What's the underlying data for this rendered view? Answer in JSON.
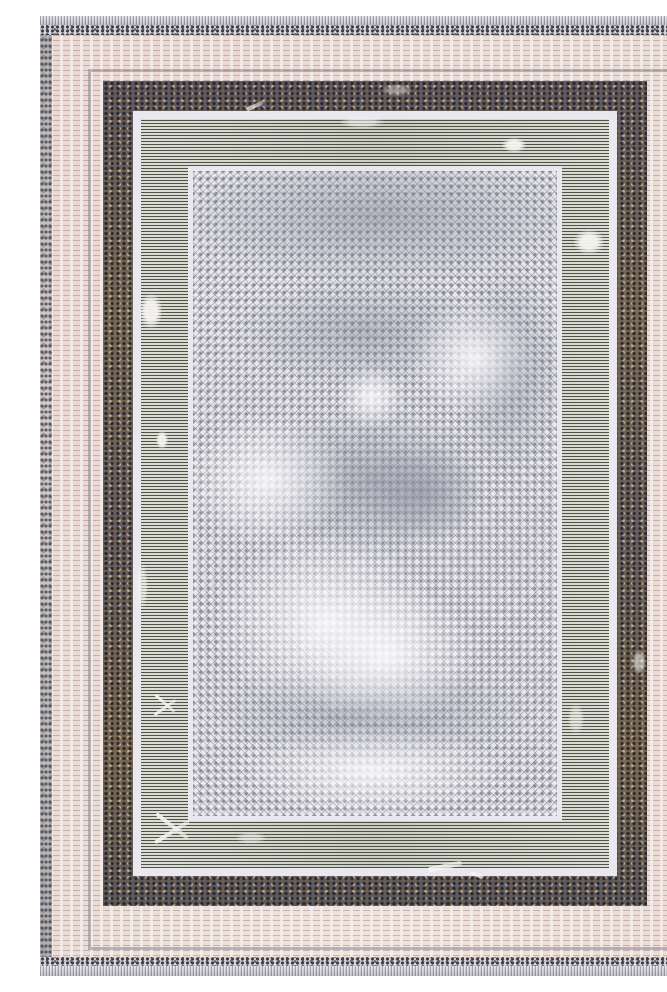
{
  "meta": {
    "type": "product-photo",
    "subject": "vintage-style distressed area rug, flat top-down view",
    "alt": "Blush-beige and grey distressed area rug with nested rectangular borders: speckled guard stripes and fringe at top and bottom, a blush outer border with a thin pencil line, a mottled charcoal-brown border, ivory lines, an olive-grey pinstripe band, and a faded diamond trellis centre field"
  },
  "palette": {
    "fringe": "#cdcdd5",
    "speckleBase": "#d8d6da",
    "speckleDot": "#3c3c44",
    "creamBase": "#ecdcd6",
    "edge": "#cfc9cb",
    "thinLine": "#8f8f98",
    "darkBorder": "#6b6560",
    "darkBorderBrown": "#8d7257",
    "darkBorderTan": "#bba88f",
    "whiteLine": "#e9e8ee",
    "bandDark": "#4f5449",
    "bandLight": "#d8d7d0",
    "fieldBase": "#e7e7eb",
    "fieldLattice": "#8e909c",
    "cloudDark": "#9296a6",
    "cloudLight": "#f8f8fa"
  },
  "layers": [
    {
      "name": "fringe-top",
      "description": "pale grey stitched fringe strip",
      "color": "#cdcdd5"
    },
    {
      "name": "guard-stripe",
      "description": "dense dark speckled stripe",
      "color": "#3c3c44"
    },
    {
      "name": "outer-border",
      "description": "blush cream distressed border with fine dark dashes",
      "color": "#ecdcd6"
    },
    {
      "name": "pencil-line",
      "description": "thin grey rectangle line",
      "color": "#8f8f98"
    },
    {
      "name": "mottled-border",
      "description": "charcoal grey and rust-brown mottled border",
      "color": "#6b6560"
    },
    {
      "name": "ivory-line-outer",
      "description": "ivory separator line",
      "color": "#e9e8ee"
    },
    {
      "name": "pinstripe-band",
      "description": "olive-grey fine horizontal pinstripe band with white abrasion",
      "color": "#4f5449"
    },
    {
      "name": "ivory-line-inner",
      "description": "ivory separator line",
      "color": "#e9e8ee"
    },
    {
      "name": "trellis-field",
      "description": "light grey diamond trellis field with dots and cloudy fading",
      "color": "#e7e7eb"
    }
  ]
}
